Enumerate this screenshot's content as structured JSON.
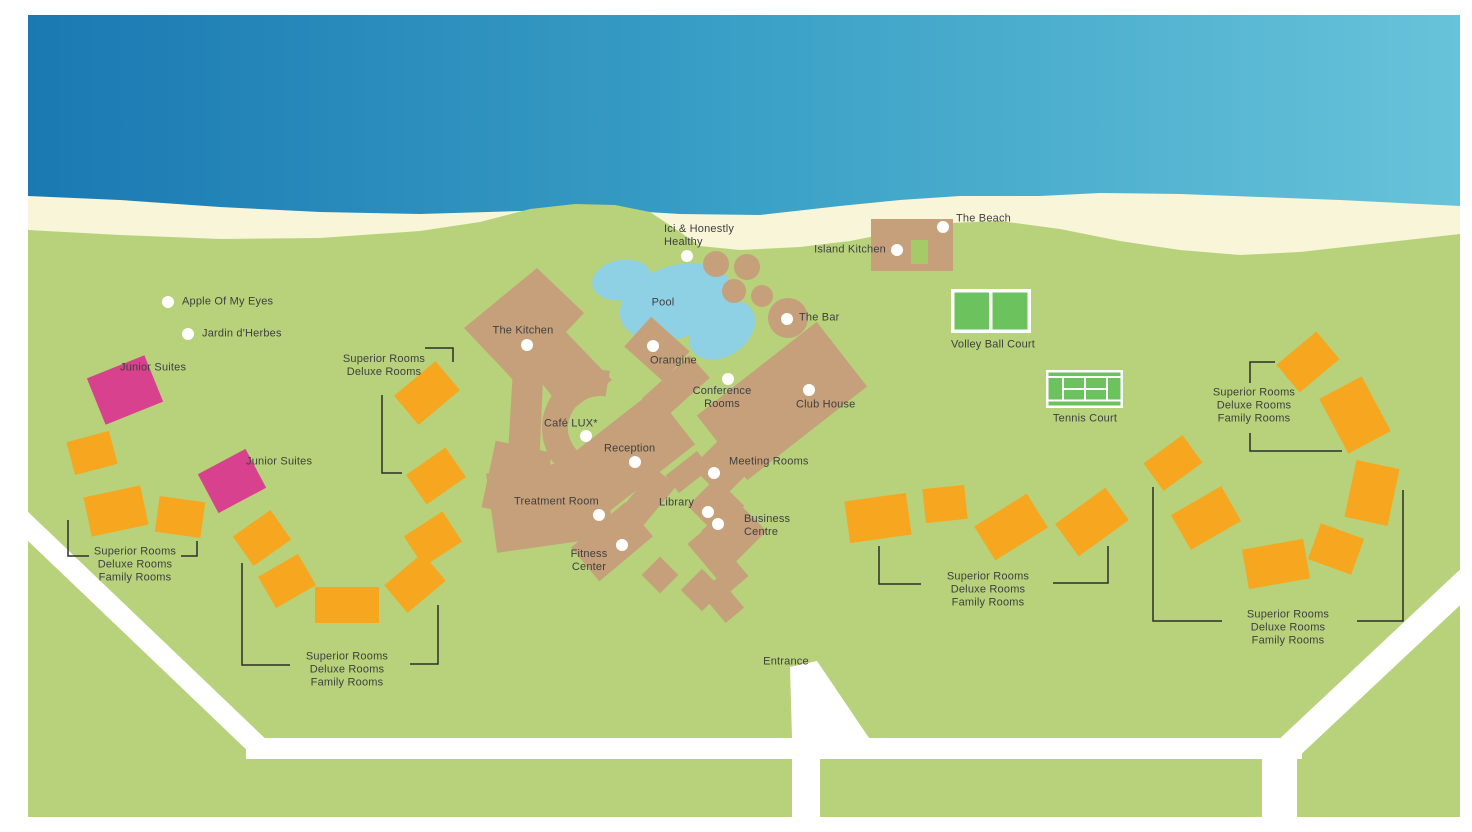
{
  "map_name": "resort-site-map",
  "colors": {
    "ocean_left": "#1a79b2",
    "ocean_mid": "#3aa0c6",
    "ocean_right": "#67c3d9",
    "beach": "#f8f5d8",
    "land": "#b7d27b",
    "building": "#c5a07b",
    "pool": "#8ed0e4",
    "court_green": "#6cc35e",
    "road": "#ffffff",
    "room_block": "#f6a71f",
    "junior_suite": "#d7418d",
    "island_kitchen_inner": "#a5ca68",
    "text": "#3f3f3f",
    "marker": "#ffffff",
    "bracket": "#2e2e2e"
  },
  "labels": [
    {
      "id": "apple-of-my-eyes",
      "text": "Apple Of My Eyes",
      "x": 182,
      "y": 302,
      "anchor": "l",
      "marker": [
        168,
        302
      ]
    },
    {
      "id": "jardin-d-herbes",
      "text": "Jardin d'Herbes",
      "x": 202,
      "y": 334,
      "anchor": "l",
      "marker": [
        188,
        334
      ]
    },
    {
      "id": "ici-honestly-healthy",
      "text": "Ici & Honestly\nHealthy",
      "x": 664,
      "y": 236,
      "anchor": "l",
      "marker": [
        687,
        256
      ]
    },
    {
      "id": "the-beach",
      "text": "The Beach",
      "x": 956,
      "y": 219,
      "anchor": "l",
      "marker": [
        943,
        227
      ]
    },
    {
      "id": "island-kitchen",
      "text": "Island Kitchen",
      "x": 886,
      "y": 250,
      "anchor": "r",
      "marker": [
        897,
        250
      ]
    },
    {
      "id": "the-kitchen",
      "text": "The Kitchen",
      "x": 523,
      "y": 331,
      "anchor": "c",
      "marker": [
        527,
        345
      ]
    },
    {
      "id": "pool",
      "text": "Pool",
      "x": 663,
      "y": 303,
      "anchor": "c",
      "marker": null
    },
    {
      "id": "orangine",
      "text": "Orangine",
      "x": 650,
      "y": 361,
      "anchor": "l",
      "marker": [
        653,
        346
      ]
    },
    {
      "id": "conference-rooms",
      "text": "Conference\nRooms",
      "x": 722,
      "y": 398,
      "anchor": "c",
      "marker": [
        728,
        379
      ]
    },
    {
      "id": "the-bar",
      "text": "The Bar",
      "x": 799,
      "y": 318,
      "anchor": "l",
      "marker": [
        787,
        319
      ]
    },
    {
      "id": "club-house",
      "text": "Club House",
      "x": 796,
      "y": 405,
      "anchor": "l",
      "marker": [
        809,
        390
      ]
    },
    {
      "id": "cafe-lux",
      "text": "Café LUX*",
      "x": 544,
      "y": 424,
      "anchor": "l",
      "marker": [
        586,
        436
      ]
    },
    {
      "id": "reception",
      "text": "Reception",
      "x": 604,
      "y": 449,
      "anchor": "l",
      "marker": [
        635,
        462
      ]
    },
    {
      "id": "meeting-rooms",
      "text": "Meeting Rooms",
      "x": 729,
      "y": 462,
      "anchor": "l",
      "marker": [
        714,
        473
      ]
    },
    {
      "id": "library",
      "text": "Library",
      "x": 659,
      "y": 503,
      "anchor": "l",
      "marker": [
        708,
        512
      ]
    },
    {
      "id": "business-centre",
      "text": "Business\nCentre",
      "x": 744,
      "y": 526,
      "anchor": "l",
      "marker": [
        718,
        524
      ]
    },
    {
      "id": "treatment-room",
      "text": "Treatment Room",
      "x": 514,
      "y": 502,
      "anchor": "l",
      "marker": [
        599,
        515
      ]
    },
    {
      "id": "fitness-center",
      "text": "Fitness\nCenter",
      "x": 589,
      "y": 561,
      "anchor": "c",
      "marker": [
        622,
        545
      ]
    },
    {
      "id": "entrance",
      "text": "Entrance",
      "x": 786,
      "y": 662,
      "anchor": "c",
      "marker": null
    },
    {
      "id": "volley-ball-court",
      "text": "Volley Ball Court",
      "x": 993,
      "y": 345,
      "anchor": "c",
      "marker": null
    },
    {
      "id": "tennis-court",
      "text": "Tennis Court",
      "x": 1085,
      "y": 419,
      "anchor": "c",
      "marker": null
    },
    {
      "id": "junior-suites-1",
      "text": "Junior Suites",
      "x": 120,
      "y": 368,
      "anchor": "l",
      "marker": null
    },
    {
      "id": "junior-suites-2",
      "text": "Junior Suites",
      "x": 246,
      "y": 462,
      "anchor": "l",
      "marker": null
    },
    {
      "id": "rooms-upper-left",
      "text": "Superior Rooms\nDeluxe Rooms",
      "x": 384,
      "y": 366,
      "anchor": "c",
      "marker": null
    },
    {
      "id": "rooms-left",
      "text": "Superior Rooms\nDeluxe Rooms\nFamily Rooms",
      "x": 135,
      "y": 565,
      "anchor": "c",
      "marker": null
    },
    {
      "id": "rooms-bottom-left",
      "text": "Superior Rooms\nDeluxe Rooms\nFamily Rooms",
      "x": 347,
      "y": 670,
      "anchor": "c",
      "marker": null
    },
    {
      "id": "rooms-center-right",
      "text": "Superior Rooms\nDeluxe Rooms\nFamily Rooms",
      "x": 988,
      "y": 590,
      "anchor": "c",
      "marker": null
    },
    {
      "id": "rooms-top-right",
      "text": "Superior Rooms\nDeluxe Rooms\nFamily Rooms",
      "x": 1254,
      "y": 406,
      "anchor": "c",
      "marker": null
    },
    {
      "id": "rooms-bottom-right",
      "text": "Superior Rooms\nDeluxe Rooms\nFamily Rooms",
      "x": 1288,
      "y": 628,
      "anchor": "c",
      "marker": null
    }
  ],
  "rooms": {
    "standard": [
      [
        92,
        453,
        44,
        34,
        -15
      ],
      [
        116,
        511,
        58,
        40,
        -12
      ],
      [
        180,
        517,
        46,
        36,
        8
      ],
      [
        427,
        393,
        54,
        38,
        -40
      ],
      [
        436,
        476,
        48,
        36,
        -35
      ],
      [
        433,
        539,
        46,
        36,
        -33
      ],
      [
        415,
        583,
        50,
        36,
        -40
      ],
      [
        347,
        605,
        64,
        36,
        0
      ],
      [
        287,
        581,
        46,
        36,
        -30
      ],
      [
        262,
        538,
        46,
        36,
        -35
      ],
      [
        878,
        518,
        62,
        42,
        -8
      ],
      [
        945,
        504,
        42,
        34,
        -6
      ],
      [
        1011,
        527,
        62,
        40,
        -32
      ],
      [
        1092,
        522,
        62,
        40,
        -36
      ],
      [
        1173,
        463,
        48,
        34,
        -36
      ],
      [
        1206,
        518,
        58,
        40,
        -30
      ],
      [
        1276,
        564,
        62,
        40,
        -10
      ],
      [
        1336,
        549,
        46,
        38,
        20
      ],
      [
        1372,
        493,
        44,
        58,
        12
      ],
      [
        1355,
        415,
        48,
        62,
        -28
      ],
      [
        1308,
        362,
        52,
        36,
        -40
      ]
    ],
    "junior_suites": [
      [
        125,
        390,
        62,
        50,
        -22
      ],
      [
        232,
        481,
        54,
        44,
        -28
      ]
    ]
  },
  "brackets": [
    [
      [
        425,
        348
      ],
      [
        453,
        348
      ],
      [
        453,
        362
      ]
    ],
    [
      [
        382,
        395
      ],
      [
        382,
        473
      ],
      [
        402,
        473
      ]
    ],
    [
      [
        89,
        556
      ],
      [
        68,
        556
      ],
      [
        68,
        520
      ]
    ],
    [
      [
        181,
        556
      ],
      [
        197,
        556
      ],
      [
        197,
        541
      ]
    ],
    [
      [
        290,
        665
      ],
      [
        242,
        665
      ],
      [
        242,
        563
      ]
    ],
    [
      [
        410,
        664
      ],
      [
        438,
        664
      ],
      [
        438,
        605
      ]
    ],
    [
      [
        921,
        584
      ],
      [
        879,
        584
      ],
      [
        879,
        546
      ]
    ],
    [
      [
        1053,
        583
      ],
      [
        1108,
        583
      ],
      [
        1108,
        546
      ]
    ],
    [
      [
        1275,
        362
      ],
      [
        1250,
        362
      ],
      [
        1250,
        383
      ]
    ],
    [
      [
        1250,
        433
      ],
      [
        1250,
        451
      ],
      [
        1342,
        451
      ]
    ],
    [
      [
        1222,
        621
      ],
      [
        1153,
        621
      ],
      [
        1153,
        487
      ]
    ],
    [
      [
        1357,
        621
      ],
      [
        1403,
        621
      ],
      [
        1403,
        490
      ]
    ]
  ]
}
